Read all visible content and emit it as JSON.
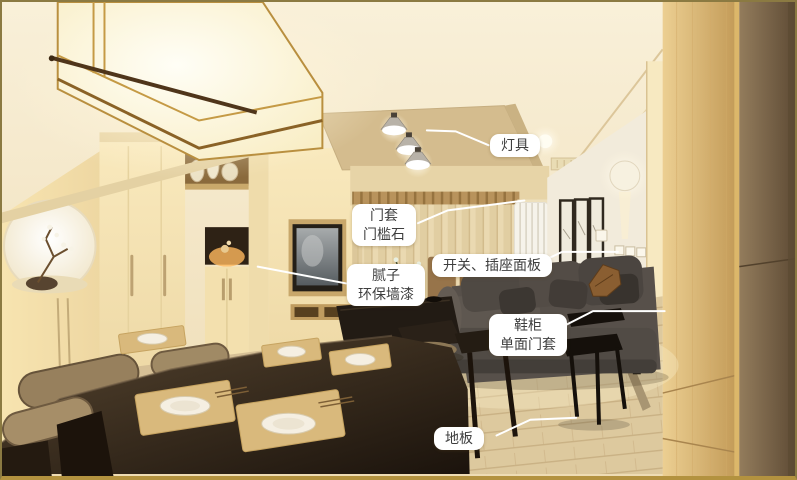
{
  "annotations": {
    "labels": [
      {
        "name": "lighting",
        "lines": [
          "灯具"
        ]
      },
      {
        "name": "door-casing",
        "lines": [
          "门套",
          "门槛石"
        ]
      },
      {
        "name": "switch-socket-panel",
        "lines": [
          "开关、插座面板"
        ]
      },
      {
        "name": "putty-wall-paint",
        "lines": [
          "腻子",
          "环保墙漆"
        ]
      },
      {
        "name": "shoe-cabinet",
        "lines": [
          "鞋柜",
          "单面门套"
        ]
      },
      {
        "name": "floor",
        "lines": [
          "地板"
        ]
      }
    ]
  },
  "colors": {
    "label_background": "#ffffff",
    "label_text": "#3e3e3e",
    "leader_line": "#ffffff",
    "frame_border": "#8b7a42",
    "frame_border_bottom": "#b3923f",
    "wall_warm": "#f2e3c0",
    "ceiling_recess": "#d4bc8e",
    "sofa": "#56504a",
    "dining_table_wood": "#2c2318",
    "floor_wood": "#dcc89e",
    "entry_cabinet_wood": "#d3ab66",
    "entry_door_panel": "#7a6448"
  }
}
